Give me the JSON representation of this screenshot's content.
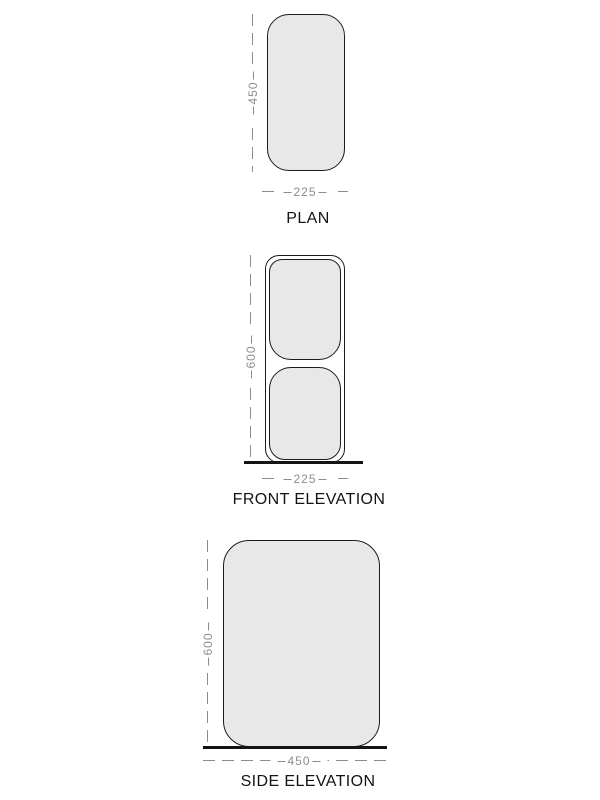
{
  "drawing": {
    "views": [
      {
        "id": "plan",
        "label": "PLAN",
        "width_dim": "225",
        "height_dim": "450"
      },
      {
        "id": "front-elevation",
        "label": "FRONT ELEVATION",
        "width_dim": "225",
        "height_dim": "600"
      },
      {
        "id": "side-elevation",
        "label": "SIDE ELEVATION",
        "width_dim": "450",
        "height_dim": "600"
      }
    ],
    "colors": {
      "shape_fill": "#e8e8e8",
      "outline": "#1c1c1c",
      "dimension": "#8c8c8c",
      "ground_line": "#141414",
      "background": "#ffffff"
    }
  }
}
